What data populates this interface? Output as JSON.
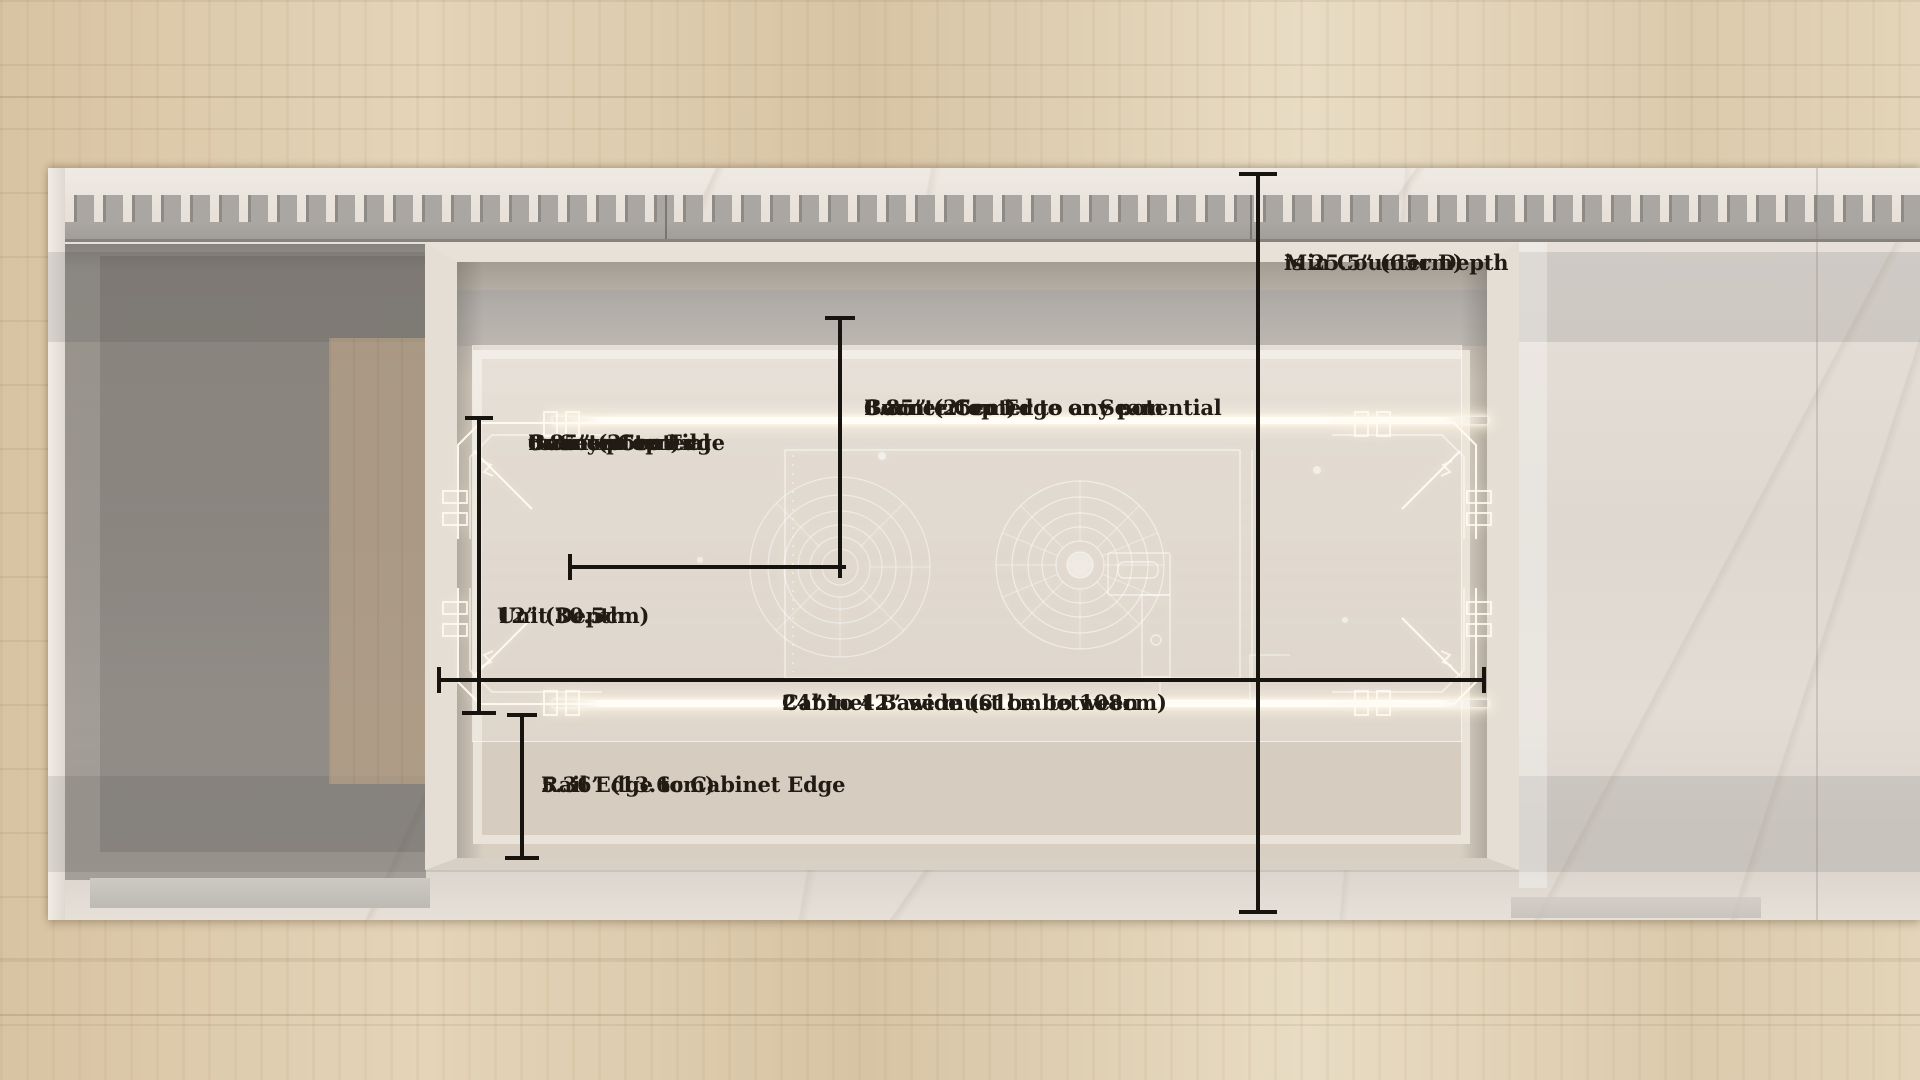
{
  "labels": {
    "min_counter_depth": {
      "lines": [
        "Min Counter Depth",
        "is 25.5” (65cm)"
      ]
    },
    "burner_center_right": {
      "lines": [
        "8.85” (25cm)",
        "Burner Center to any potential",
        "Countertop Edge or Seam"
      ]
    },
    "burner_center_left": {
      "lines": [
        "8.85” (25cm)",
        "Burner Center",
        "to any potential",
        "Countertop Edge",
        "or Seam"
      ]
    },
    "unit_depth": {
      "lines": [
        "12” (30.5cm)",
        "Unit Depth"
      ]
    },
    "cabinet_base": {
      "lines": [
        "Cabinet Base must be between",
        "24” to 42” wide (61cm to 108cm)"
      ]
    },
    "rail_edge_to_cabinet_edge": {
      "lines": [
        "5.36” (13.6cm)",
        "Rail Edge to Cabinet Edge"
      ]
    }
  },
  "colors": {
    "dimension_line": "#17130e",
    "label_text": "#221b14",
    "rail_glow": "#fff8ec",
    "wood_floor": "#dcc9ab",
    "marble_counter": "#e7e1da",
    "vent_grille_gray": "#a8a4a0",
    "open_cabinet_shadow": "#8f8a83",
    "cabinet_interior": "#d8cec1"
  }
}
